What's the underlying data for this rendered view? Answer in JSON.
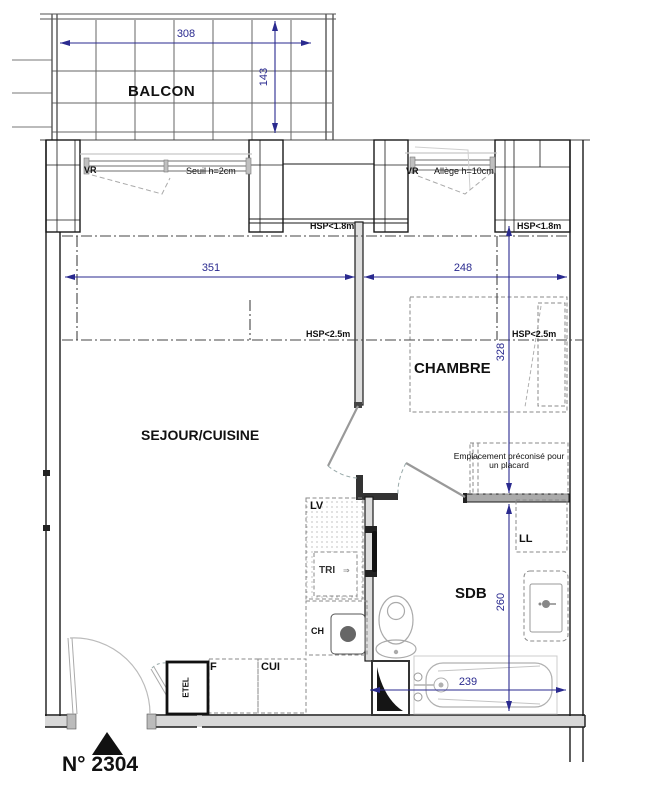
{
  "plan": {
    "number": "N° 2304",
    "rooms": {
      "balcony": "BALCON",
      "living": "SEJOUR/CUISINE",
      "bedroom": "CHAMBRE",
      "bathroom": "SDB"
    },
    "annotations": {
      "vr": "VR",
      "seuil": "Seuil h=2cm",
      "allege": "Allège h=10cm",
      "hsp_low": "HSP<1.8m",
      "hsp_mid": "HSP<2.5m",
      "placard_line1": "Emplacement préconisé pour",
      "placard_line2": "un placard"
    },
    "fixtures": {
      "lv": "LV",
      "tri": "TRI",
      "tri_note": "⇒",
      "ch": "CH",
      "ll": "LL",
      "f": "F",
      "cui": "CUI",
      "etel": "ETEL"
    },
    "dimensions": {
      "balcony_width": "308",
      "balcony_depth": "143",
      "living_width": "351",
      "bedroom_width": "248",
      "bedroom_depth": "328",
      "bathroom_depth": "260",
      "bathroom_width": "239"
    },
    "colors": {
      "dimension_blue": "#2a2a8f",
      "wall_black": "#1a1a1a",
      "furniture_gray": "#8a8a8a"
    }
  }
}
